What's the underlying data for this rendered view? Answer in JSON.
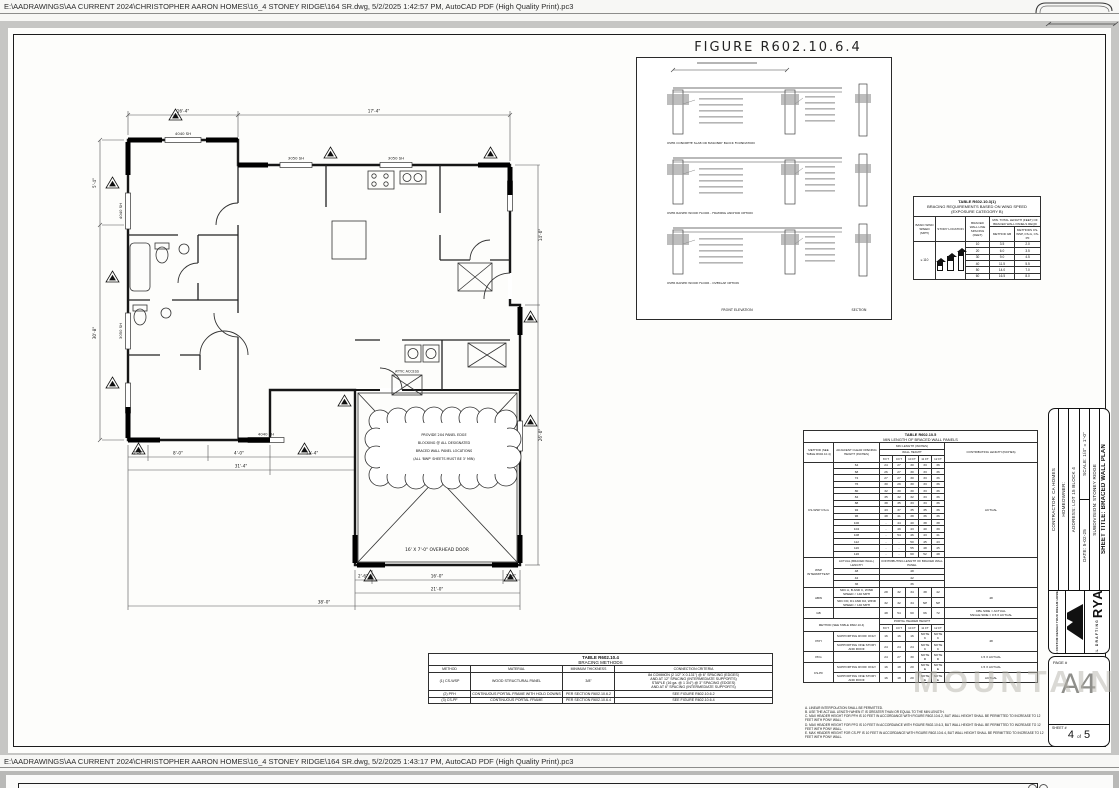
{
  "chrome": {
    "top_path": "E:\\AADRAWINGS\\AA CURRENT 2024\\CHRISTOPHER AARON HOMES\\16_4 STONEY RIDGE\\164 SR.dwg, 5/2/2025 1:42:57 PM, AutoCAD PDF (High Quality Print).pc3",
    "bottom_path": "E:\\AADRAWINGS\\AA CURRENT 2024\\CHRISTOPHER AARON HOMES\\16_4 STONEY RIDGE\\164 SR.dwg, 5/2/2025 1:43:17 PM, AutoCAD PDF (High Quality Print).pc3"
  },
  "watermark": "MOUNTAIN",
  "figure": {
    "title": "FIGURE R602.10.6.4",
    "captions": [
      "OVER CONCRETE SLAB OR MASONRY BLOCK FOUNDATION",
      "OVER RAISED WOOD FLOOR - FRAMING ANCHOR OPTION",
      "OVER RAISED WOOD FLOOR - OVERLAP OPTION"
    ],
    "bottom_labels": [
      "FRONT ELEVATION",
      "SECTION"
    ]
  },
  "plan": {
    "labels": {
      "w1": "4040 SH",
      "w2": "3050 SH",
      "w3": "3050 SH",
      "w4": "4040 SH",
      "w5": "4040 SH",
      "w6": "3050 SH",
      "attic": "ATTIC ACCESS",
      "door": "16' X 7'-0\" OVERHEAD DOOR"
    },
    "cloud": [
      "PROVIDE 2X4 PANEL EDGE",
      "BLOCKING @ ALL DESIGNATED",
      "BRACED WALL PANEL LOCATIONS",
      "(ALL 'BWP' SHEETS MUST BE 3' MIN)"
    ],
    "dims": {
      "t1": "16'-4\"",
      "t2": "17'-4\"",
      "l1": "5'-4\"",
      "l2": "30'-8\"",
      "b1": "2'-8\"",
      "b2": "8'-0\"",
      "b3": "4'-0\"",
      "b4": "11'-4\"",
      "b5": "31'-4\"",
      "g1": "2'-6\"",
      "g2": "16'-0\"",
      "g3": "2'-6\"",
      "g4": "21'-0\"",
      "g5": "38'-0\"",
      "r1": "14'-0\"",
      "r2": "26'-0\""
    }
  },
  "wind_table": {
    "title": "TABLE R602.10.3(1)",
    "subtitle": "BRACING REQUIREMENTS BASED ON WIND SPEED",
    "subtitle2": "(EXPOSURE CATEGORY B)",
    "col_headers": [
      "BASIC WIND SPEED (MPH)",
      "STORY LOCATION",
      "BRACED WALL LINE SPACING (FEET)",
      "MIN. TOTAL LENGTH (FEET) OF BRACED WALL PANELS REQD"
    ],
    "method_headers": [
      "METHOD GB",
      "METHODS CS-WSP, CS-G, CS-PF"
    ],
    "wind_speed": "≤ 110",
    "spacing": [
      "10",
      "20",
      "30",
      "40",
      "50",
      "60"
    ],
    "gb": [
      "3.5",
      "6.0",
      "9.0",
      "11.5",
      "14.0",
      "16.5"
    ],
    "cs": [
      "2.0",
      "3.5",
      "4.5",
      "5.5",
      "7.0",
      "8.0"
    ]
  },
  "min_length_table": {
    "title": "TABLE R602.10.5",
    "subtitle": "MIN LENGTH OF BRACED WALL PANELS",
    "h_method": "METHOD (SEE TABLE R602.10.4)",
    "h_opening": "ADJACENT CLEAR OPENING HEIGHT (INCHES)",
    "h_minlen": "MIN LENGTH (INCHES)",
    "h_wall": "WALL HEIGHT",
    "heights": [
      "8 FT",
      "9 FT",
      "10 FT",
      "11 FT",
      "12 FT"
    ],
    "h_contrib": "CONTRIBUTING LENGTH (INCHES)",
    "method_label": "CS-WSP CS-G",
    "contrib_label": "ACTUAL",
    "rows": [
      [
        "64",
        [
          "24",
          "27",
          "30",
          "33",
          "36"
        ]
      ],
      [
        "68",
        [
          "26",
          "27",
          "30",
          "33",
          "36"
        ]
      ],
      [
        "72",
        [
          "27",
          "27",
          "30",
          "33",
          "36"
        ]
      ],
      [
        "76",
        [
          "30",
          "29",
          "30",
          "33",
          "36"
        ]
      ],
      [
        "80",
        [
          "32",
          "30",
          "30",
          "33",
          "36"
        ]
      ],
      [
        "84",
        [
          "35",
          "32",
          "32",
          "33",
          "36"
        ]
      ],
      [
        "88",
        [
          "38",
          "35",
          "33",
          "33",
          "36"
        ]
      ],
      [
        "92",
        [
          "43",
          "37",
          "35",
          "35",
          "36"
        ]
      ],
      [
        "96",
        [
          "48",
          "41",
          "38",
          "36",
          "36"
        ]
      ],
      [
        "100",
        [
          "-",
          "44",
          "40",
          "38",
          "38"
        ]
      ],
      [
        "104",
        [
          "-",
          "49",
          "43",
          "40",
          "39"
        ]
      ],
      [
        "108",
        [
          "-",
          "54",
          "46",
          "43",
          "41"
        ]
      ],
      [
        "112",
        [
          "-",
          "-",
          "50",
          "45",
          "43"
        ]
      ],
      [
        "116",
        [
          "-",
          "-",
          "55",
          "48",
          "45"
        ]
      ],
      [
        "120",
        [
          "-",
          "-",
          "60",
          "52",
          "48"
        ]
      ]
    ],
    "wsp": {
      "label": "WSP INTERMITTENT",
      "h1": "ACTUAL (BRACED WALL) LENGTH",
      "h2": "CONTRIBUTING LENGTH OF BRACED WALL PANEL",
      "rows": [
        [
          "48",
          "48"
        ],
        [
          "42",
          "42"
        ],
        [
          "36",
          "36"
        ]
      ]
    },
    "abw": {
      "label": "ABW",
      "rows": [
        {
          "desc": "SDC A, B AND C, WIND SPEED < 140 MPH",
          "vals": [
            "28",
            "32",
            "34",
            "38",
            "42"
          ]
        },
        {
          "desc": "SDC D0, D1 AND D2, WIND SPEED < 140 MPH",
          "vals": [
            "32",
            "32",
            "34",
            "NP",
            "NP"
          ]
        }
      ],
      "contrib": "48"
    },
    "gb": {
      "label": "GB",
      "vals": [
        "48",
        "54",
        "60",
        "66",
        "72"
      ],
      "contrib": [
        "DBL SIDE = ACTUAL",
        "SNGLE SIDE = 0.5 X ACTUAL"
      ]
    },
    "portal": {
      "h_method": "METHOD (SEE TABLE R602.10.4)",
      "h_header": "PORTAL HEADER HEIGHT",
      "heights": [
        "8 FT",
        "9 FT",
        "10 FT",
        "11 FT",
        "12 FT"
      ],
      "rows": [
        {
          "m": "PFH",
          "span": 2,
          "desc": "SUPPORTING ROOF ONLY",
          "vals": [
            "16",
            "16",
            "16",
            "NOTE C",
            "NOTE C"
          ],
          "contrib": "48",
          "cspan": 2
        },
        {
          "m": "",
          "span": 0,
          "desc": "SUPPORTING ONE STORY AND ROOF",
          "vals": [
            "24",
            "24",
            "24",
            "NOTE C",
            "NOTE C"
          ],
          "contrib": "",
          "cspan": 0
        },
        {
          "m": "PFG",
          "span": 1,
          "desc": "",
          "vals": [
            "24",
            "27",
            "30",
            "NOTE D",
            "NOTE D"
          ],
          "contrib": "1.5 X ACTUAL",
          "cspan": 1
        },
        {
          "m": "CS-PF",
          "span": 2,
          "desc": "SUPPORTING ROOF ONLY",
          "vals": [
            "16",
            "18",
            "20",
            "NOTE E",
            "NOTE E"
          ],
          "contrib": "1.5 X ACTUAL",
          "cspan": 1
        },
        {
          "m": "",
          "span": 0,
          "desc": "SUPPORTING ONE STORY AND ROOF",
          "vals": [
            "16",
            "18",
            "20",
            "NOTE E",
            "NOTE E"
          ],
          "contrib": "ACTUAL",
          "cspan": 1
        }
      ]
    },
    "footnotes": [
      "A. LINEAR INTERPOLATION SHALL BE PERMITTED.",
      "B. USE THE ACTUAL LENGTH WHEN IT IS GREATER THAN OR EQUAL TO THE MIN LENGTH.",
      "C. MAX HEADER HEIGHT FOR PFH IS 10 FEET IN ACCORDANCE WITH FIGURE R602.10.6.2, BUT WALL HEIGHT SHALL BE PERMITTED TO INCREASE TO 12 FEET WITH PONY WALL.",
      "D. MAX HEADER HEIGHT FOR PFG IS 10 FEET IN ACCORDANCE WITH FIGURE R602.10.6.3, BUT WALL HEIGHT SHALL BE PERMITTED TO INCREASE TO 12 FEET WITH PONY WALL.",
      "E. MAX HEADER HEIGHT FOR CS-PF IS 10 FEET IN ACCORDANCE WITH FIGURE R602.10.6.4, BUT WALL HEIGHT SHALL BE PERMITTED TO INCREASE TO 12 FEET WITH PONY WALL."
    ]
  },
  "methods_table": {
    "title": "TABLE R602.10.4",
    "subtitle": "BRACING METHODS",
    "headers": [
      "METHOD",
      "MATERIAL",
      "MINIMUM THICKNESS",
      "CONNECTION CRITERIA"
    ],
    "rows": [
      {
        "method": "(1) CS-WSP",
        "material": "WOOD STRUCTURAL PANEL",
        "thickness": "3/8\"",
        "criteria": [
          "8d COMMON (2 1/2\" X 0.131\") @ 6\" SPACING (EDGES)",
          "AND AT 12\" SPACING (INTERMEDIATE SUPPORTS)",
          "STAPLE (16 ga. @ 1 3/4\") @ 3\" SPACING (EDGES)",
          "AND AT 6\" SPACING (INTERMEDIATE SUPPORTS)"
        ]
      },
      {
        "method": "(2) PFH",
        "material": "CONTINUOUS PORTAL FRAME WITH HOLD DOWNS",
        "thickness": "PER SECTION R602.10.6.2",
        "criteria": [
          "SEE FIGURE R602.10.6.2"
        ]
      },
      {
        "method": "(3) CS-PF",
        "material": "CONTINUOUS PORTAL FRAME",
        "thickness": "PER SECTION R602.10.6.4",
        "criteria": [
          "SEE FIGURE R602.10.6.4"
        ]
      }
    ]
  },
  "titleblock": {
    "contractor": "CONTRACTOR: CA HOMES",
    "homeowner": "HOMEOWNER:",
    "address": "ADDRESS: LOT 15  BLOCK 4",
    "scale": "SCALE: 1/4\" = 1'-0\"",
    "date": "DATE: 5-02-25",
    "subdivision": "SUBDIVISION: STONEY RIDGE",
    "sheet_title": "SHEET TITLE: BRACED WALL PLAN",
    "company": "RYAN",
    "company2": "STEEL DRAFTING",
    "tagline": "CUSTOM DESIGN YOUR DREAM HOME",
    "phone": "Ph:",
    "email": "Email:",
    "page_label": "PAGE #",
    "page": "A4",
    "sheet_label": "SHEET #",
    "sheet_no": "4",
    "sheet_of": "of",
    "sheet_total": "5"
  }
}
